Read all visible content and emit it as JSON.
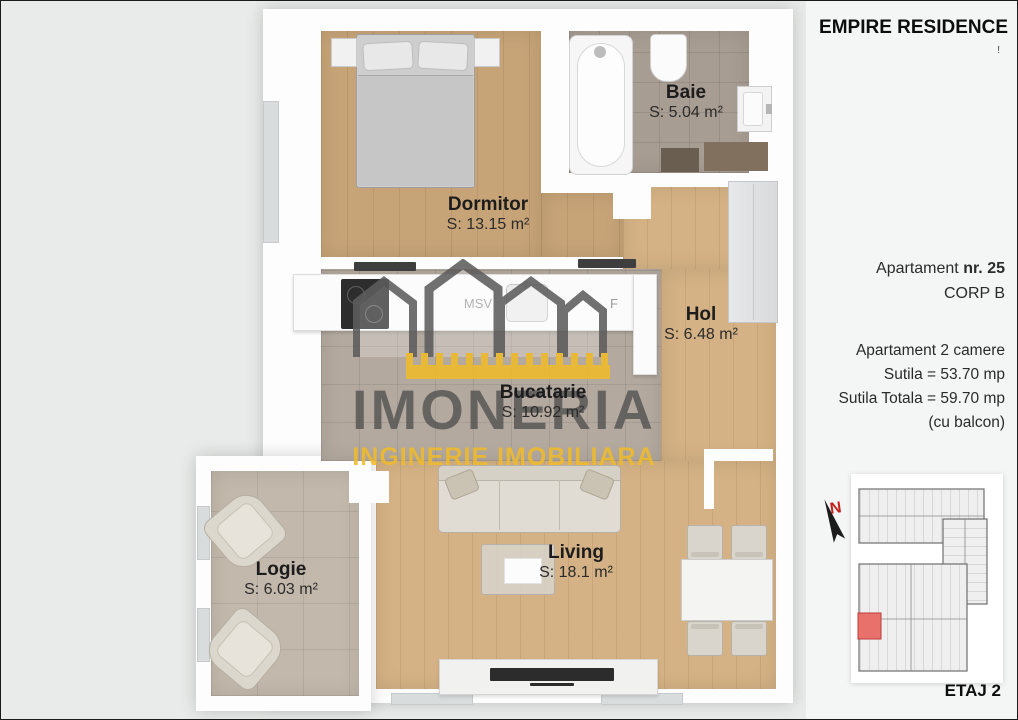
{
  "sidebar": {
    "title": "EMPIRE RESIDENCE",
    "title_mark": "!",
    "apartment_prefix": "Apartament ",
    "apartment_number": "nr. 25",
    "corp": "CORP B",
    "details": [
      "Apartament 2 camere",
      "Sutila = 53.70 mp",
      "Sutila Totala = 59.70 mp",
      "(cu balcon)"
    ],
    "compass_label": "N",
    "floor_label": "ETAJ 2"
  },
  "floorplan": {
    "rooms": [
      {
        "name": "Dormitor",
        "area": "S: 13.15 m²"
      },
      {
        "name": "Baie",
        "area": "S: 5.04 m²"
      },
      {
        "name": "Hol",
        "area": "S: 6.48 m²"
      },
      {
        "name": "Bucatarie",
        "area": "S: 10.92 m²"
      },
      {
        "name": "Living",
        "area": "S: 18.1 m²"
      },
      {
        "name": "Logie",
        "area": "S: 6.03 m²"
      }
    ],
    "appliance_labels": {
      "dishwasher": "MSV",
      "fridge": "F"
    }
  },
  "watermark": {
    "brand": "IMONERIA",
    "tagline": "INGINERIE IMOBILIARA"
  },
  "colors": {
    "plan_bg": "#e9ebea",
    "wall_white": "#fdfdfd",
    "wood_dorm": "#c7a478",
    "wood_living": "#d4b285",
    "tile_kitchen": "#b3a99f",
    "tile_bath": "#a89d93",
    "tile_logie": "#c2b8ab",
    "watermark_yellow": "#f0bb2b",
    "watermark_gray": "#5d5d5d",
    "map_highlight": "#e8716c",
    "north_red": "#c6201e",
    "text_dark": "#1c1c1c",
    "sidebar_bg": "#f4f5f5"
  }
}
